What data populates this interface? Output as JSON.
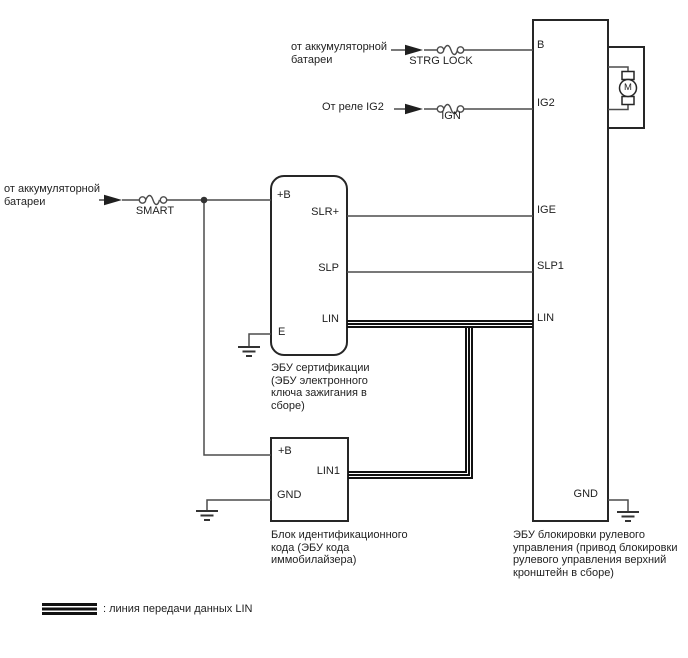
{
  "diagram": {
    "colors": {
      "background": "#ffffff",
      "wire": "#4c4c4c",
      "block_border": "#262626",
      "lin_bus": "#111111",
      "text": "#1f1f1f"
    },
    "sources": {
      "battery_top": "от аккумуляторной\nбатареи",
      "ig2_relay": "От реле IG2",
      "battery_left": "от аккумуляторной\nбатареи"
    },
    "fuses": {
      "strg_lock": "STRG LOCK",
      "ign": "IGN",
      "smart": "SMART"
    },
    "certification_ecu": {
      "t_plus_b": "+B",
      "t_slr": "SLR+",
      "t_slp": "SLP",
      "t_lin": "LIN",
      "t_e": "E",
      "caption": "ЭБУ сертификации\n(ЭБУ электронного\nключа зажигания в\nсборе)"
    },
    "id_code_box": {
      "t_plus_b": "+B",
      "t_lin1": "LIN1",
      "t_gnd": "GND",
      "caption": "Блок идентификационного\nкода (ЭБУ кода\nиммобилайзера)"
    },
    "steering_lock_ecu": {
      "t_b": "B",
      "t_ig2": "IG2",
      "t_ige": "IGE",
      "t_slp1": "SLP1",
      "t_lin": "LIN",
      "t_gnd": "GND",
      "caption": "ЭБУ блокировки рулевого\nуправления (привод блокировки\nрулевого управления верхний\nкронштейн в сборе)"
    },
    "motor": {
      "label": "M"
    },
    "legend": {
      "text": ": линия передачи данных LIN"
    }
  }
}
